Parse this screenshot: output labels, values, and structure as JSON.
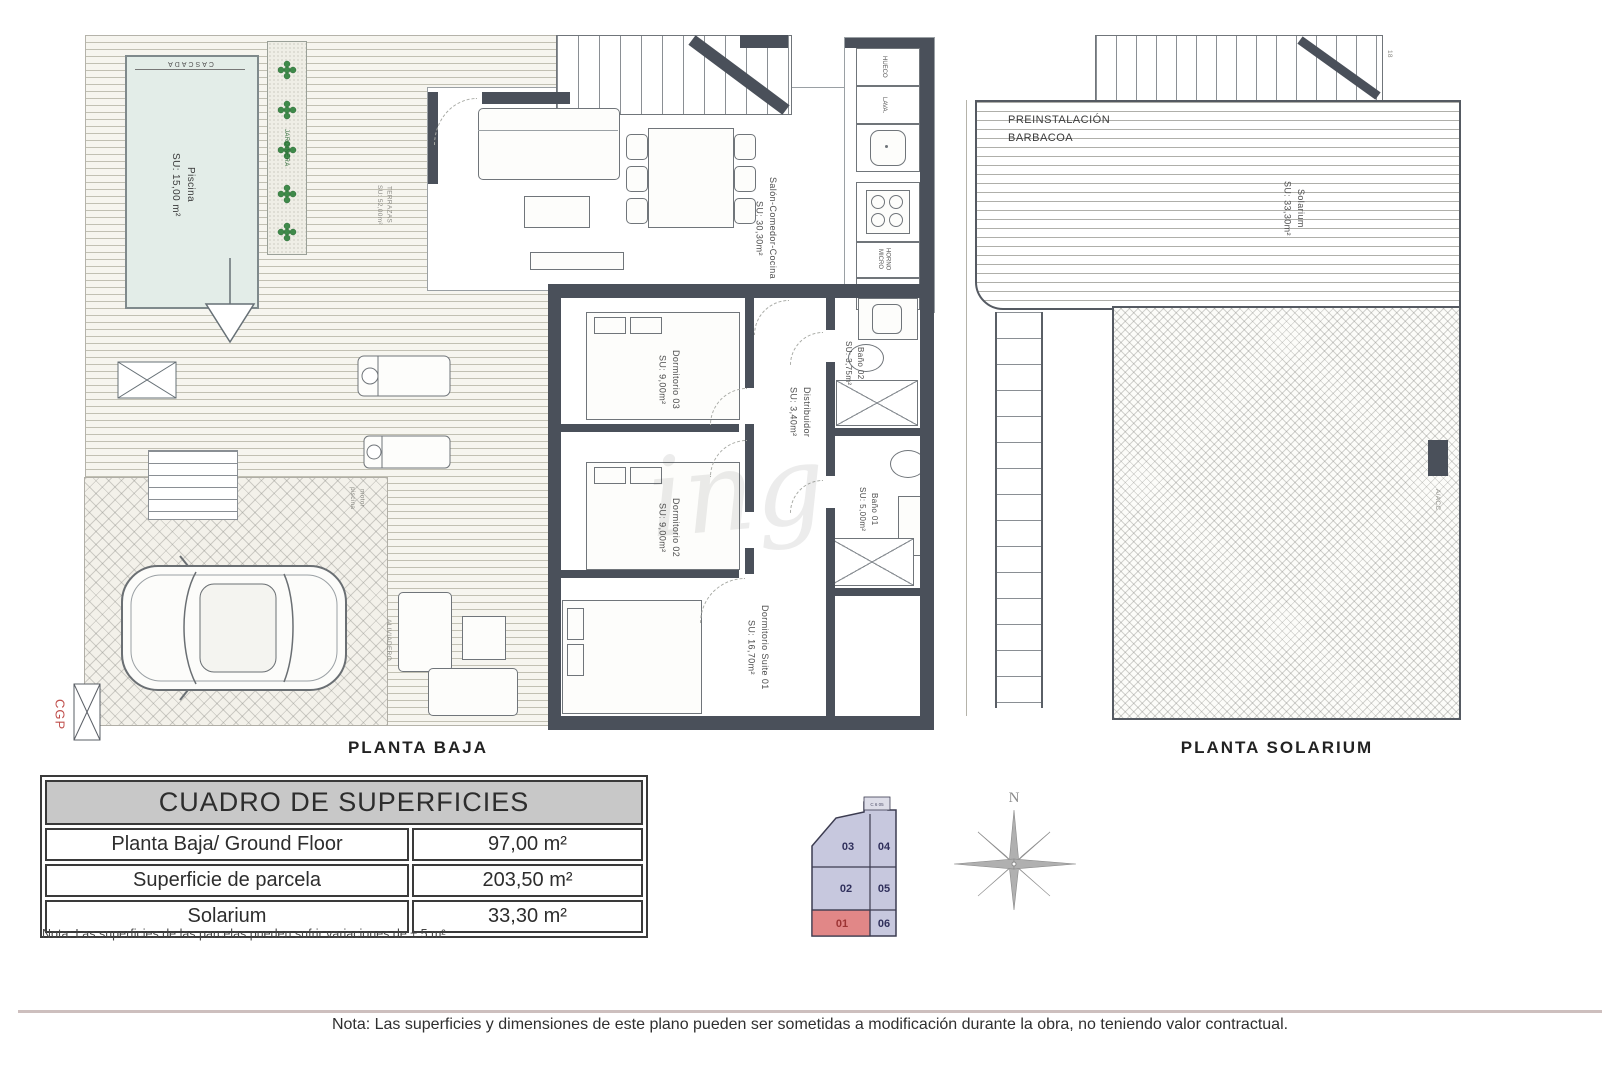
{
  "planta_baja": {
    "title": "PLANTA BAJA",
    "piscina": {
      "name": "Piscina",
      "area": "SU: 15,00 m²",
      "cascada": "CASCADA"
    },
    "jardinera": "JARDINERA",
    "terrazas": {
      "name": "TERRAZAS",
      "area": "SU: 52,00m²"
    },
    "salon": {
      "name": "Salón-Comedor-Cocina",
      "area": "SU: 30,30m²"
    },
    "dormitorio03": {
      "name": "Dormitorio 03",
      "area": "SU: 9,00m²"
    },
    "dormitorio02": {
      "name": "Dormitorio 02",
      "area": "SU: 9,00m²"
    },
    "suite01": {
      "name": "Dormitorio Suite 01",
      "area": "SU: 16,70m²"
    },
    "distribuidor": {
      "name": "Distribuidor",
      "area": "SU: 3,40m²"
    },
    "bano02": {
      "name": "Baño 02",
      "area": "SU: 3,75m²"
    },
    "bano01": {
      "name": "Baño 01",
      "area": "SU: 5,00m²"
    },
    "kitchen": {
      "hueco": "HUECO",
      "lava": "LAVA.",
      "horno_micro": "HORNO MICRO",
      "frigo": "FRIGO"
    },
    "motor_piscina": "motor piscina",
    "aliviadero": "ALIVIADERO",
    "cgp": "CGP"
  },
  "planta_solarium": {
    "title": "PLANTA SOLARIUM",
    "preinstalacion_line1": "PREINSTALACIÓN",
    "preinstalacion_line2": "BARBACOA",
    "solarium": {
      "name": "Solarium",
      "area": "SU: 33,30m²"
    },
    "aacc": "A/ACC",
    "stair_number": "18"
  },
  "surface_table": {
    "title": "CUADRO DE SUPERFICIES",
    "rows": [
      {
        "label": "Planta Baja/ Ground Floor",
        "value": "97,00 m²"
      },
      {
        "label": "Superficie de parcela",
        "value": "203,50 m²"
      },
      {
        "label": "Solarium",
        "value": "33,30 m²"
      }
    ],
    "note": "Nota: Las superficies de las parcelas pueden sufrir variaciones de ± 5 m²"
  },
  "key_plan": {
    "parcels": [
      "03",
      "04",
      "02",
      "05",
      "01",
      "06"
    ],
    "highlighted": "01",
    "corner_label": "C 6 05"
  },
  "compass": {
    "north_label": "N"
  },
  "watermark": "ing",
  "footer": {
    "note": "Nota: Las superficies y dimensiones de este plano pueden ser sometidas a modificación durante la obra, no teniendo valor contractual."
  },
  "colors": {
    "wall": "#4a505a",
    "pool_fill": "#e3ede8",
    "parcel_fill": "#c7c8de",
    "parcel_highlight": "#e18787",
    "plant_green": "#3f8a4a",
    "table_header_bg": "#c8c8c8"
  }
}
